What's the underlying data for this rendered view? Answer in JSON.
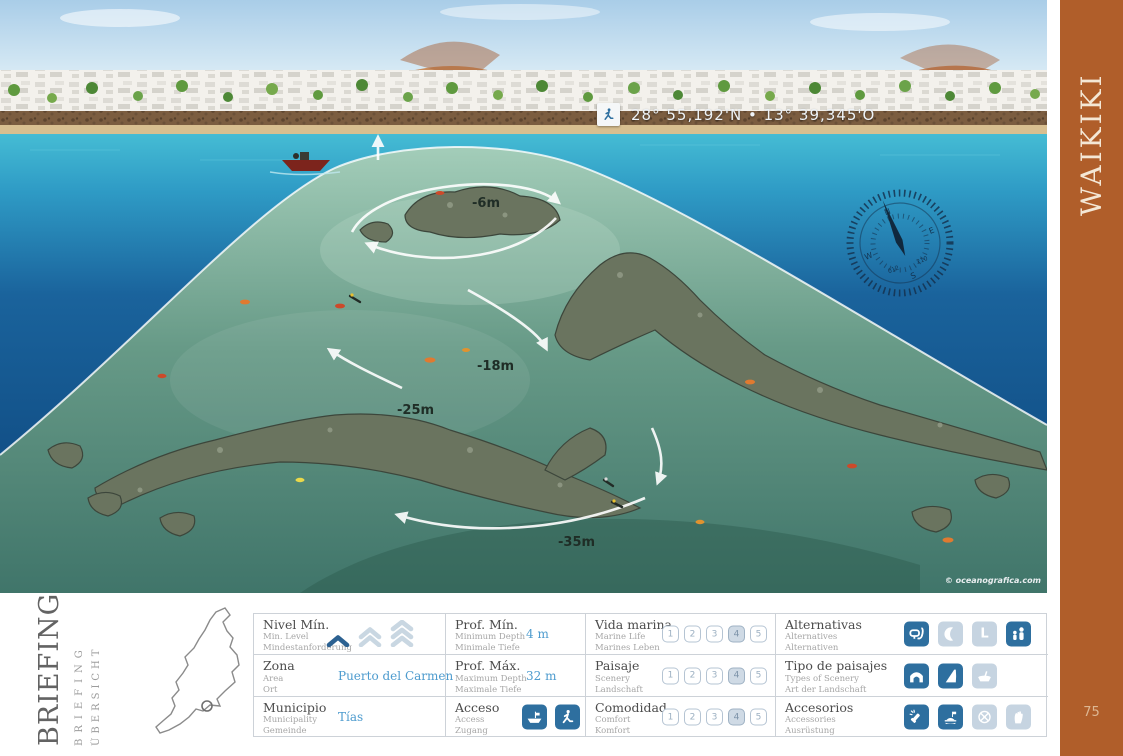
{
  "sidebar": {
    "title": "WAIKIKI",
    "page_number": "75"
  },
  "illustration": {
    "coordinates": "28° 55,192'N  •  13° 39,345'O",
    "credit": "© oceanografica.com",
    "depth_labels": [
      {
        "label": "-6m"
      },
      {
        "label": "-18m"
      },
      {
        "label": "-25m"
      },
      {
        "label": "-35m"
      }
    ],
    "compass": {
      "n": "N",
      "e": "E",
      "s": "S",
      "w": "W",
      "deg_a": "012",
      "deg_b": "210"
    }
  },
  "briefing": {
    "title_es": "BRIEFING",
    "title_en": "BRIEFING",
    "title_de": "ÜBERSICHT"
  },
  "table": {
    "scale": [
      "1",
      "2",
      "3",
      "4",
      "5"
    ],
    "letter_l": "L",
    "info": [
      {
        "label": "Nivel Mín.",
        "sub1": "Min. Level",
        "sub2": "Mindestanforderung",
        "level": "1"
      },
      {
        "label": "Zona",
        "sub1": "Area",
        "sub2": "Ort",
        "value": "Puerto del Carmen"
      },
      {
        "label": "Municipio",
        "sub1": "Municipality",
        "sub2": "Gemeinde",
        "value": "Tías"
      }
    ],
    "depth": [
      {
        "label": "Prof. Mín.",
        "sub1": "Minimum Depth",
        "sub2": "Minimale Tiefe",
        "value": "4 m"
      },
      {
        "label": "Prof. Máx.",
        "sub1": "Maximum Depth",
        "sub2": "Maximale Tiefe",
        "value": "32 m"
      },
      {
        "label": "Acceso",
        "sub1": "Access",
        "sub2": "Zugang",
        "icons": [
          "boat",
          "shore-entry"
        ]
      }
    ],
    "ratings": [
      {
        "label": "Vida marina",
        "sub1": "Marine Life",
        "sub2": "Marines Leben",
        "rating": "4"
      },
      {
        "label": "Paisaje",
        "sub1": "Scenery",
        "sub2": "Landschaft",
        "rating": "4"
      },
      {
        "label": "Comodidad",
        "sub1": "Comfort",
        "sub2": "Komfort",
        "rating": "4"
      }
    ],
    "features": [
      {
        "label": "Alternativas",
        "sub1": "Alternatives",
        "sub2": "Alternativen",
        "icons": [
          {
            "name": "snorkel",
            "active": true
          },
          {
            "name": "night",
            "active": false
          },
          {
            "name": "level-l",
            "active": false
          },
          {
            "name": "family",
            "active": true
          }
        ]
      },
      {
        "label": "Tipo de paisajes",
        "sub1": "Types of Scenery",
        "sub2": "Art der Landschaft",
        "icons": [
          {
            "name": "arch",
            "active": true
          },
          {
            "name": "wall",
            "active": true
          },
          {
            "name": "wreck",
            "active": false
          }
        ]
      },
      {
        "label": "Accesorios",
        "sub1": "Accessories",
        "sub2": "Ausrüstung",
        "icons": [
          {
            "name": "torch",
            "active": true
          },
          {
            "name": "buoy",
            "active": true
          },
          {
            "name": "reel",
            "active": false
          },
          {
            "name": "gloves",
            "active": false
          }
        ]
      }
    ]
  }
}
